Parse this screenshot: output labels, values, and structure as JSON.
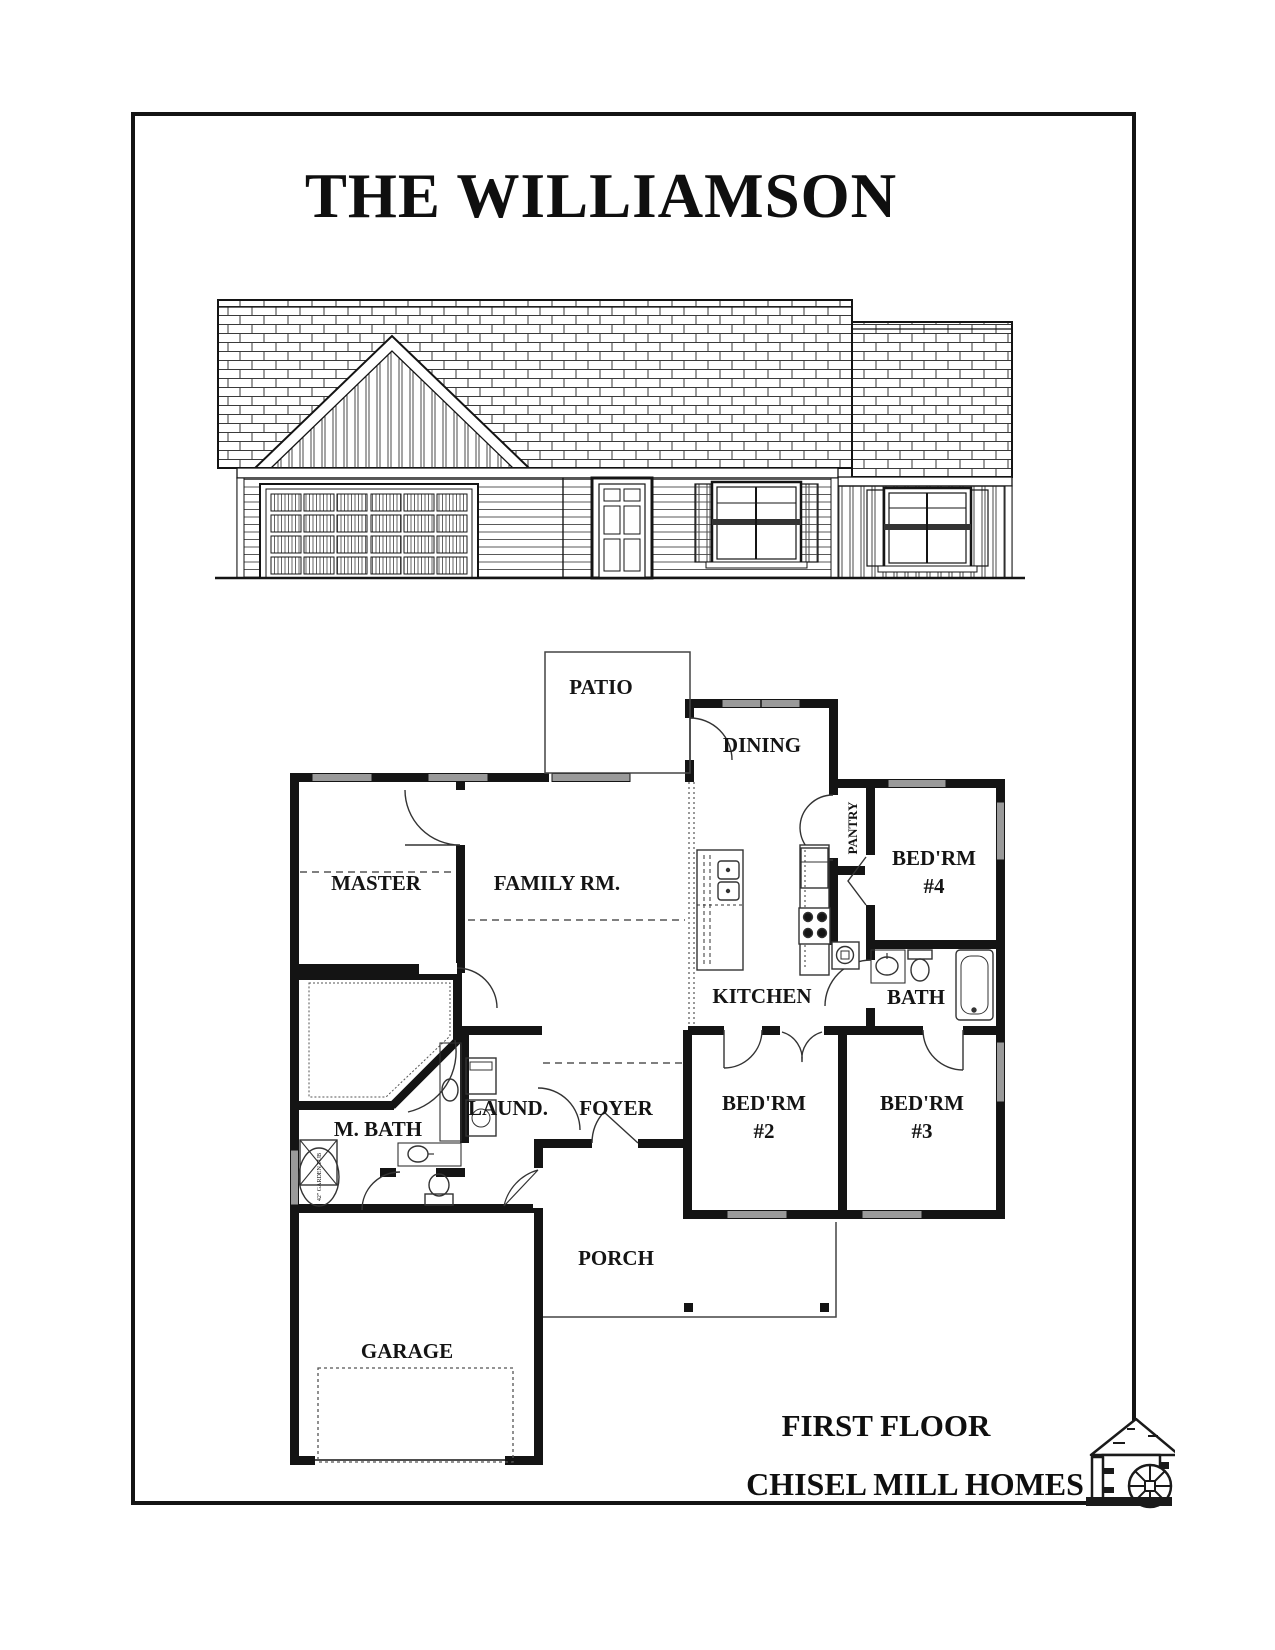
{
  "title": "THE WILLIAMSON",
  "rooms": {
    "patio": {
      "label": "PATIO"
    },
    "dining": {
      "label": "DINING"
    },
    "pantry": {
      "label": "PANTRY"
    },
    "master": {
      "label": "MASTER"
    },
    "family": {
      "label": "FAMILY RM."
    },
    "kitchen": {
      "label": "KITCHEN"
    },
    "bath": {
      "label": "BATH"
    },
    "mbath": {
      "label": "M. BATH"
    },
    "laundry": {
      "label": "LAUND."
    },
    "foyer": {
      "label": "FOYER"
    },
    "bed2": {
      "name": "BED'RM",
      "num": "#2"
    },
    "bed3": {
      "name": "BED'RM",
      "num": "#3"
    },
    "bed4": {
      "name": "BED'RM",
      "num": "#4"
    },
    "porch": {
      "label": "PORCH"
    },
    "garage": {
      "label": "GARAGE"
    }
  },
  "fixtures": {
    "garden_tub": "42\" GARDEN TUB"
  },
  "footer": {
    "floor_label": "FIRST FLOOR",
    "company": "CHISEL MILL HOMES"
  },
  "icons": {
    "logo": "mill-house-waterwheel"
  },
  "colors": {
    "ink": "#141414",
    "window_gray": "#9a9a9a",
    "hatch_gray": "#555555"
  }
}
